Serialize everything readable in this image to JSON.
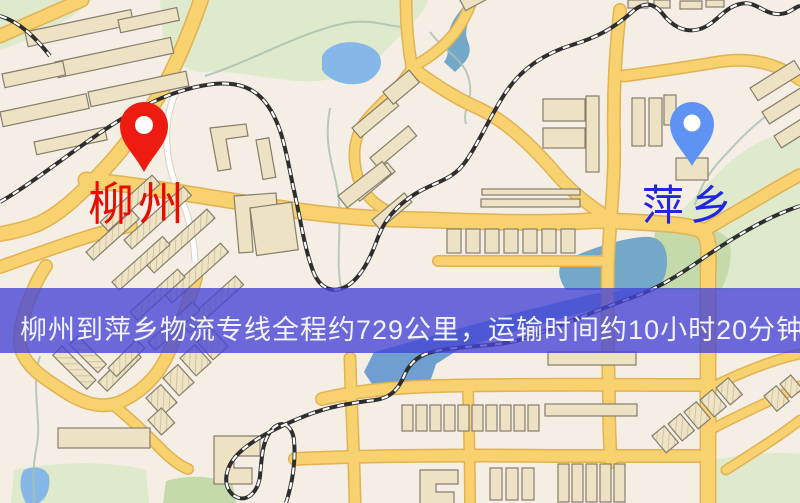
{
  "banner": {
    "text": "柳州到萍乡物流专线全程约729公里，运输时间约10小时20分钟.",
    "background_rgba": "rgba(68,68,214,0.78)",
    "text_color": "#f2f3ff"
  },
  "markers": {
    "origin": {
      "label": "柳州",
      "pin_icon": "map-pin",
      "pin_color": "#ee1b10",
      "label_color": "#e60c00"
    },
    "destination": {
      "label": "萍乡",
      "pin_icon": "map-pin",
      "pin_color": "#5e93f3",
      "label_color": "#2326df"
    }
  },
  "route_info": {
    "origin": "柳州",
    "destination": "萍乡",
    "service": "物流专线",
    "distance": "约729公里",
    "duration": "约10小时20分钟"
  },
  "map": {
    "type": "street-map",
    "features": [
      "roads",
      "railways",
      "parks",
      "water",
      "buildings"
    ],
    "colors": {
      "background": "#f4eee4",
      "road": "#f7d26e",
      "road_casing": "#e2b254",
      "minor_road": "#ffffff",
      "building": "#ede2c4",
      "building_outline": "#857e6d",
      "park": "#dfe9cb",
      "park_dark": "#c5daaa",
      "water": "#85b8e8",
      "river": "#6f9fd0",
      "water_teal": "#74a8c8",
      "railway": "#2e2e2e",
      "railway_dash": "#ffffff",
      "stream": "#a9bfae"
    }
  }
}
